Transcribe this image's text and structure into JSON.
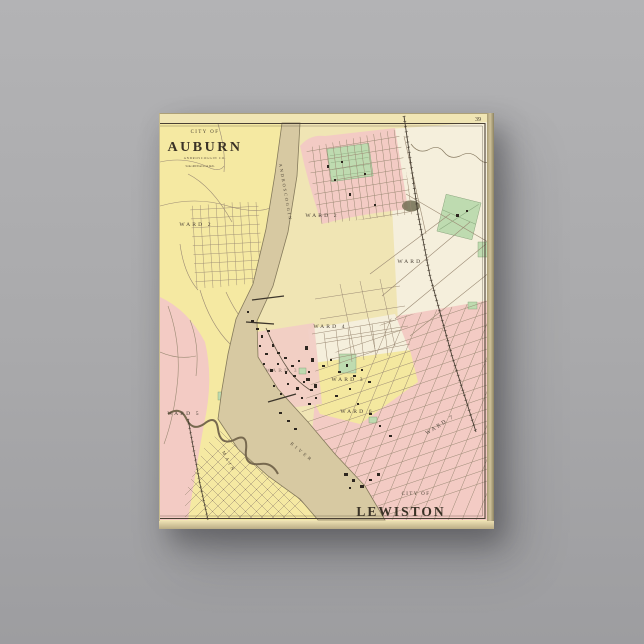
{
  "artwork": {
    "page_number": "39",
    "auburn_title": {
      "city_of": "CITY OF",
      "name": "AUBURN",
      "county": "ANDROSCOGGIN CO.",
      "scale": "Scale 400 Feet to an Inch."
    },
    "lewiston_title": {
      "city_of": "CITY OF",
      "name": "LEWISTON"
    },
    "river": {
      "upper": "ANDROSCOGGIN",
      "lower": "RIVER"
    },
    "streets": {
      "main": "MAIN"
    },
    "wards": [
      {
        "city": "Auburn",
        "label": "WARD 2"
      },
      {
        "city": "Auburn",
        "label": "WARD 3"
      },
      {
        "city": "Auburn",
        "label": "WARD 5"
      },
      {
        "city": "Lewiston",
        "label": "WARD 2"
      },
      {
        "city": "Lewiston",
        "label": "WARD 1"
      },
      {
        "city": "Lewiston",
        "label": "WARD 4"
      },
      {
        "city": "Lewiston",
        "label": "WARD 3"
      },
      {
        "city": "Lewiston",
        "label": "WARD 6"
      },
      {
        "city": "Lewiston",
        "label": "WARD 7"
      }
    ],
    "colors": {
      "background_gray": "#a9a9ab",
      "paper_cream": "#f0e5b4",
      "auburn_yellow": "#f5e9a2",
      "lewiston_pink": "#f3cbc4",
      "unshaded_cream": "#f5efdc",
      "river_tan": "#d7c9a2",
      "park_green": "#bedbb0",
      "ink_dark": "#443b2e"
    }
  }
}
